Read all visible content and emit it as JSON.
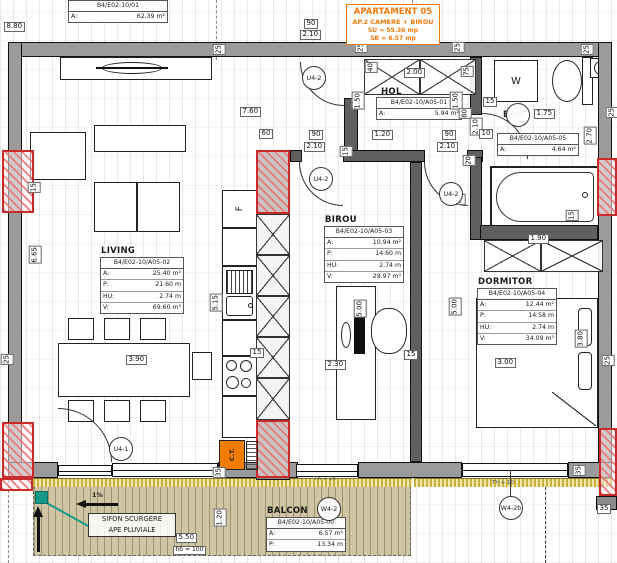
{
  "sheet": {
    "code": "B4/E02-10/01",
    "a_label": "A:",
    "a_value": "62.39 m²"
  },
  "apartment": {
    "line1": "APARTAMENT 05",
    "line2": "AP.2 CAMERE + BIROU",
    "line3": "SU = 59.36 mp",
    "line4": "SB = 6.57 mp",
    "accent_color": "#f4790b"
  },
  "rooms": {
    "hol": {
      "name": "HOL",
      "code": "B4/E02-10/A05-01",
      "a_label": "A:",
      "a": "5.94 m²"
    },
    "living": {
      "name": "LIVING",
      "code": "B4/E02-10/A05-02",
      "a_label": "A:",
      "a": "25.40 m²",
      "p_label": "P:",
      "p": "21.60 m",
      "hu_label": "HU:",
      "hu": "2.74 m",
      "v_label": "V:",
      "v": "69.60 m³"
    },
    "birou": {
      "name": "BIROU",
      "code": "B4/E02-10/A05-03",
      "a_label": "A:",
      "a": "10.94 m²",
      "p_label": "P:",
      "p": "14.60 m",
      "hu_label": "HU:",
      "hu": "2.74 m",
      "v_label": "V:",
      "v": "29.97 m³"
    },
    "dormitor": {
      "name": "DORMITOR",
      "code": "B4/E02-10/A05-04",
      "a_label": "A:",
      "a": "12.44 m²",
      "p_label": "P:",
      "p": "14.58 m",
      "hu_label": "HU:",
      "hu": "2.74 m",
      "v_label": "V:",
      "v": "34.09 m³"
    },
    "baie": {
      "name": "BAIE",
      "code": "B4/E02-10/A05-05",
      "a_label": "A:",
      "a": "4.64 m²"
    },
    "balcon": {
      "name": "BALCON",
      "code": "B4/E02-10/A05-00",
      "a_label": "A:",
      "a": "6.57 m²",
      "p_label": "P:",
      "p": "13.34 m"
    }
  },
  "tags": {
    "u41": "U4-1",
    "u42": "U4-2",
    "w42": "W4-2",
    "w42b": "W4-2b"
  },
  "equipment": {
    "washing_machine": "W",
    "fridge": "F",
    "boiler": "C.T."
  },
  "annotations": {
    "sifon_line1": "SIFON SCURGERE",
    "sifon_line2": "APE PLUVIALE",
    "slope": "1%",
    "hb": "hb = 100",
    "th_living": "Th + 16",
    "th_dorm": "Th + 10"
  },
  "dims": {
    "d880": "8.80",
    "d25": "25",
    "d90": "90",
    "d210": "2.10",
    "d200": "2.00",
    "d40": "40",
    "d75": "75",
    "d150": "1.50",
    "d760": "7.60",
    "d15": "15",
    "d175": "1.75",
    "d80": "80",
    "d10": "10",
    "d270": "2.70",
    "d60": "60",
    "d120": "1.20",
    "d95": "95",
    "d20": "20",
    "d665": "6.65",
    "d515": "5.15",
    "d390": "3.90",
    "d230": "2.30",
    "d500": "5.00",
    "d300": "3.00",
    "d380": "3.80",
    "d190": "1.90",
    "d35": "35",
    "d550": "5.50"
  },
  "colors": {
    "column_red": "#c92a2a",
    "drain_teal": "#159a8a",
    "balcony_tan": "#cfc5a2",
    "wall_gray": "#9b9b9b"
  }
}
